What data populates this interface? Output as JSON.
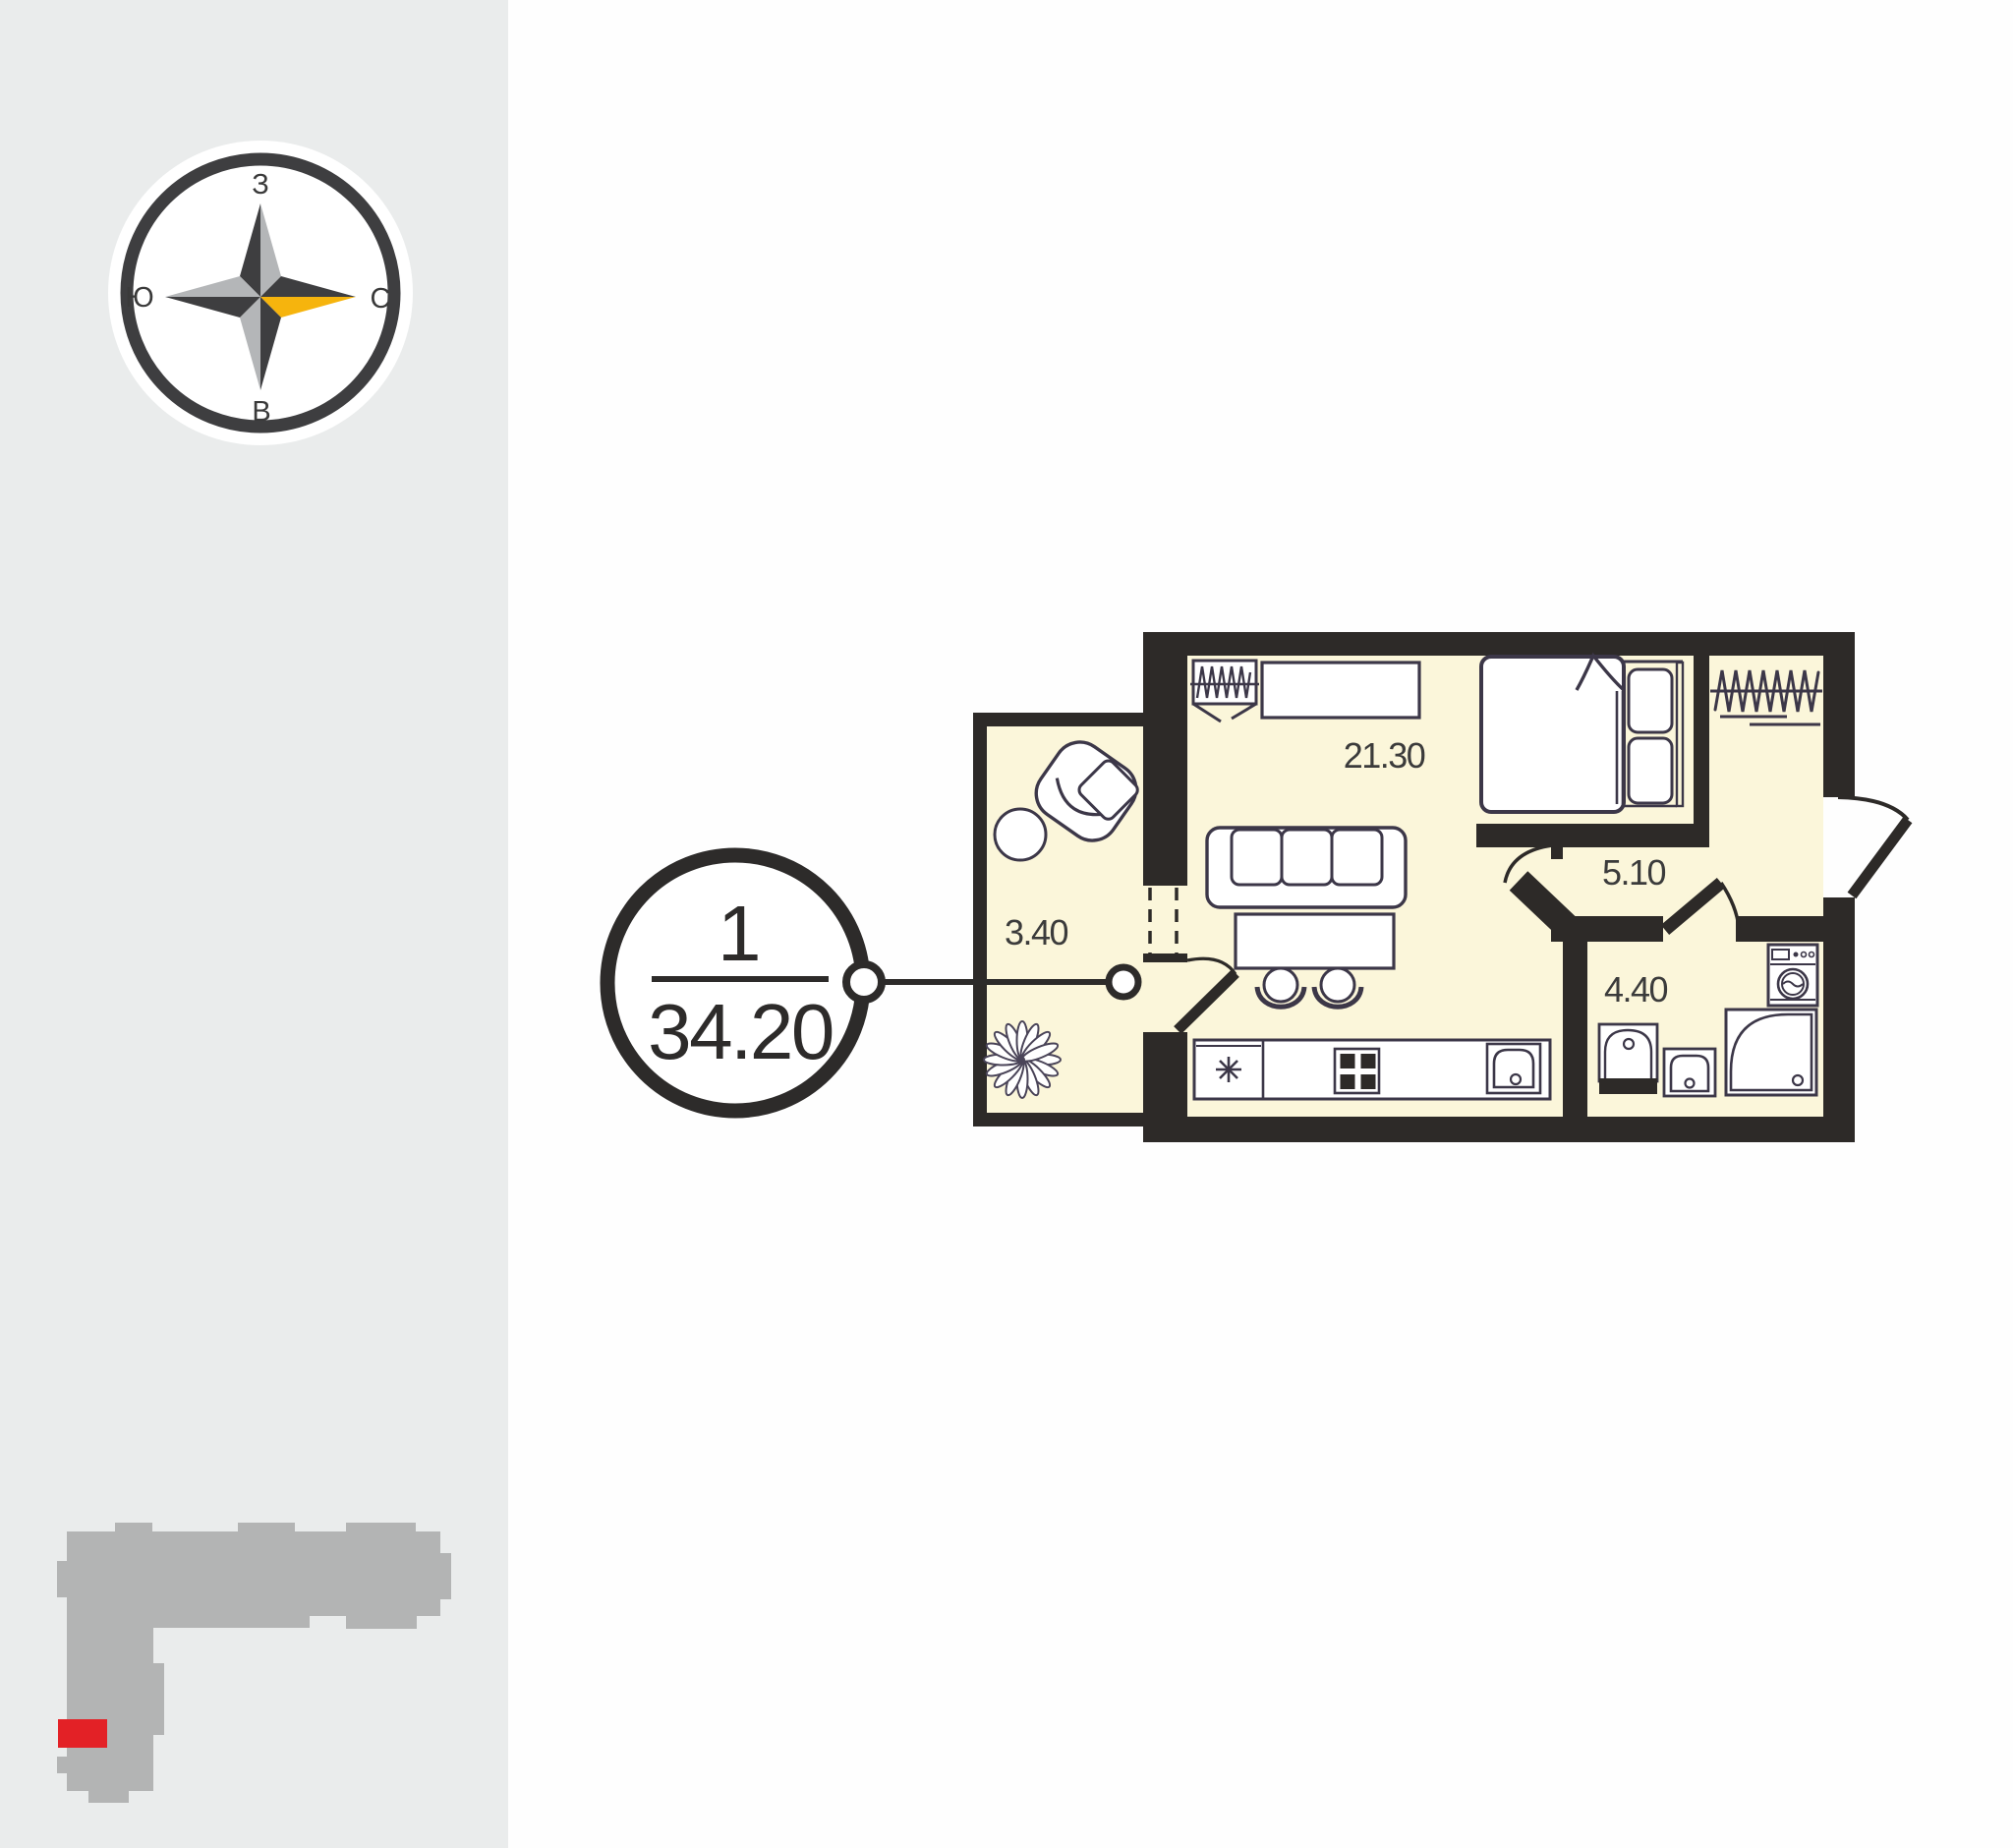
{
  "compass": {
    "top": "З",
    "right": "С",
    "bottom": "В",
    "left": "Ю"
  },
  "badge": {
    "number": "1",
    "area": "34.20"
  },
  "plan": {
    "rooms": [
      {
        "name": "living-kitchen",
        "area": "21.30"
      },
      {
        "name": "balcony",
        "area": "3.40"
      },
      {
        "name": "hallway",
        "area": "5.10"
      },
      {
        "name": "bathroom",
        "area": "4.40"
      }
    ]
  },
  "colors": {
    "sidebar_bg": "#eaecec",
    "canvas_bg": "#fefefe",
    "room_fill": "#fbf6da",
    "wall": "#2d2a28",
    "accent_yellow": "#f6b40d",
    "compass_dark": "#3e3e40",
    "compass_gray": "#b4b6b8",
    "footprint_gray": "#b3b4b4",
    "marker_red": "#e32126",
    "furniture_stroke": "#3c3748",
    "label_text": "#3b3b3b"
  }
}
